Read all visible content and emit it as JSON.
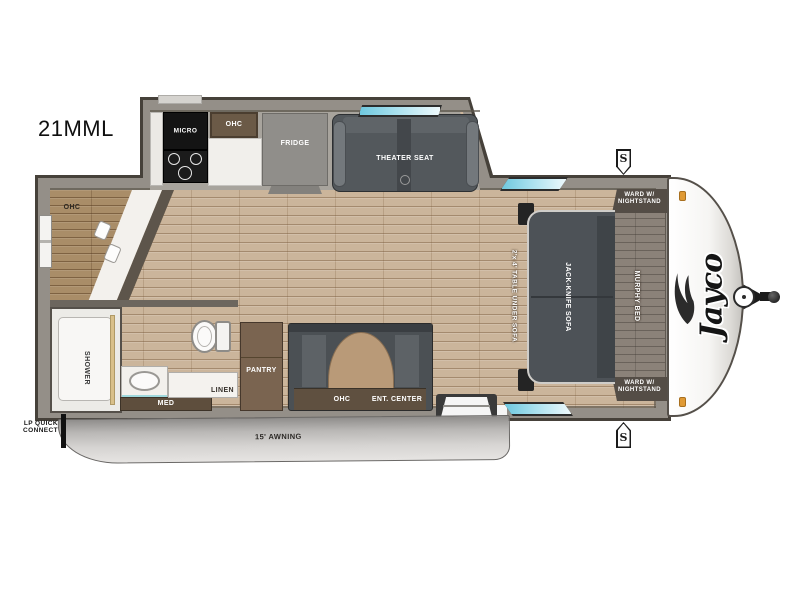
{
  "model": "21MML",
  "brand": "Jayco",
  "exterior": {
    "speaker_label": "S",
    "lp_quick_connect_line1": "LP QUICK",
    "lp_quick_connect_line2": "CONNECT",
    "awning_label": "15' AWNING"
  },
  "kitchen": {
    "micro_label": "MICRO",
    "ohc_label": "OHC",
    "fridge_label": "FRIDGE"
  },
  "living": {
    "theater_seat_label": "THEATER SEAT",
    "table_label": "2'x 4' TABLE UNDER SOFA",
    "sofa_label": "JACK-KNIFE SOFA",
    "ohc_label": "OHC",
    "ent_center_label": "ENT. CENTER"
  },
  "front_storage": {
    "ohc_label": "OHC"
  },
  "bathroom": {
    "shower_label": "SHOWER",
    "med_label": "MED",
    "linen_label": "LINEN"
  },
  "pantry": {
    "label": "PANTRY"
  },
  "bedroom": {
    "murphy_bed_label": "MURPHY BED",
    "ward_top_line1": "WARD W/",
    "ward_top_line2": "NIGHTSTAND",
    "ward_bottom_line1": "WARD W/",
    "ward_bottom_line2": "NIGHTSTAND"
  },
  "colors": {
    "wall": "#948f88",
    "floor": "#cbb59b",
    "window_glass": "#8ed5e6",
    "sofa_dark": "#4d5257",
    "cabinet_brown": "#6b5a47",
    "marker_light": "#e09a35"
  }
}
